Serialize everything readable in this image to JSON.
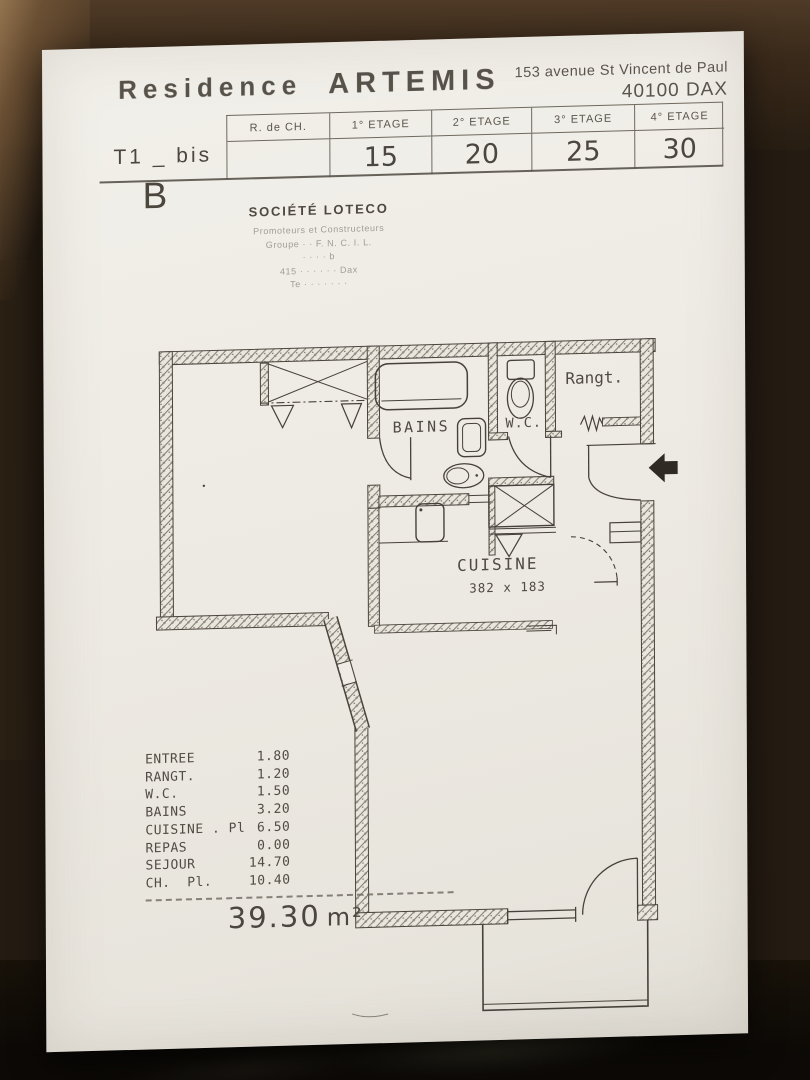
{
  "header": {
    "title_word1": "Residence",
    "title_word2": "ARTEMIS",
    "address_line1": "153 avenue St Vincent de Paul",
    "address_line2": "40100 DAX"
  },
  "unit_table": {
    "row_label": "T1 _ bis",
    "columns": [
      {
        "label": "R. de CH.",
        "value": ""
      },
      {
        "label": "1° ETAGE",
        "value": "15"
      },
      {
        "label": "2° ETAGE",
        "value": "20"
      },
      {
        "label": "3° ETAGE",
        "value": "25"
      },
      {
        "label": "4° ETAGE",
        "value": "30"
      }
    ]
  },
  "plan_letter": "B",
  "company": {
    "name": "SOCIÉTÉ LOTECO",
    "faded_lines": [
      "Promoteurs et Constructeurs",
      "Groupe · ·  F. N. C. I. L.",
      "· ·      ·     · b",
      "415 · · ·   · ·  ·  Dax",
      "Te · · ·   ·  · ·  ·"
    ]
  },
  "floor_plan": {
    "labels": {
      "bains": "BAINS",
      "wc": "W.C.",
      "rangt": "Rangt.",
      "cuisine": "CUISINE",
      "cuisine_dim": "382 x 183"
    }
  },
  "legend": {
    "rows": [
      {
        "label": "ENTREE",
        "value": "1.80"
      },
      {
        "label": "RANGT.",
        "value": "1.20"
      },
      {
        "label": "W.C.",
        "value": "1.50"
      },
      {
        "label": "BAINS",
        "value": "3.20"
      },
      {
        "label": "CUISINE . Pl",
        "value": "6.50"
      },
      {
        "label": "REPAS",
        "value": "0.00"
      },
      {
        "label": "SEJOUR",
        "value": "14.70"
      },
      {
        "label": "CH.  Pl.",
        "value": "10.40"
      }
    ],
    "total_value": "39.30",
    "total_unit": "m²"
  },
  "colors": {
    "ink": "#46413a",
    "paper": "#edeae3",
    "background": "#241b12",
    "arrow_fill": "#2f2a24"
  }
}
